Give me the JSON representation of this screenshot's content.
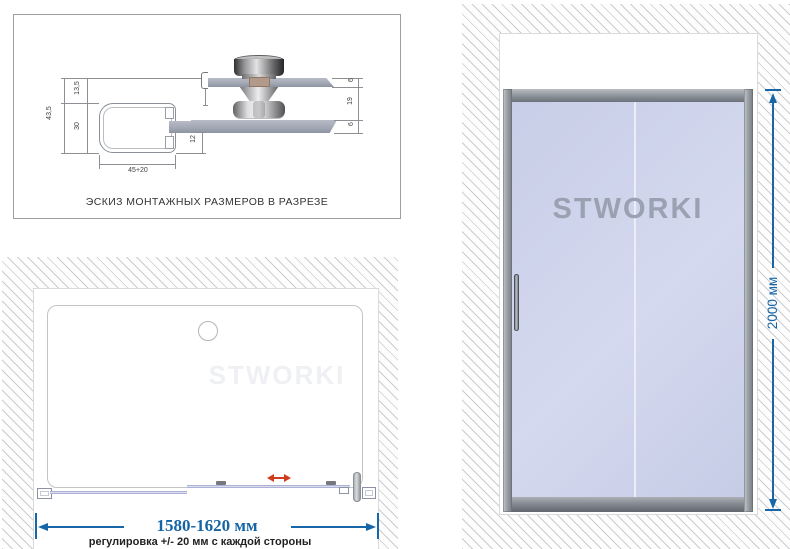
{
  "cross_section_panel": {
    "caption": "ЭСКИЗ МОНТАЖНЫХ РАЗМЕРОВ В РАЗРЕЗЕ",
    "dims": {
      "total_height": "43,5",
      "top_offset": "13,5",
      "profile_height": "30",
      "profile_width": "45+20",
      "bottom_inset": "12",
      "glass_top_thickness": "6",
      "glass_gap": "19",
      "glass_bottom_thickness": "6"
    }
  },
  "top_view_panel": {
    "watermark": "STWORKI",
    "width_label": "1580-1620 мм",
    "adjust_note": "регулировка +/- 20 мм с каждой стороны"
  },
  "front_view_panel": {
    "watermark": "STWORKI",
    "height_label": "2000 мм"
  },
  "colors": {
    "dimension_blue": "#1767a8",
    "slide_arrow_red": "#d23c1e",
    "glass_blue": "#cdd3ea",
    "frame_gray": "#8a9097"
  }
}
